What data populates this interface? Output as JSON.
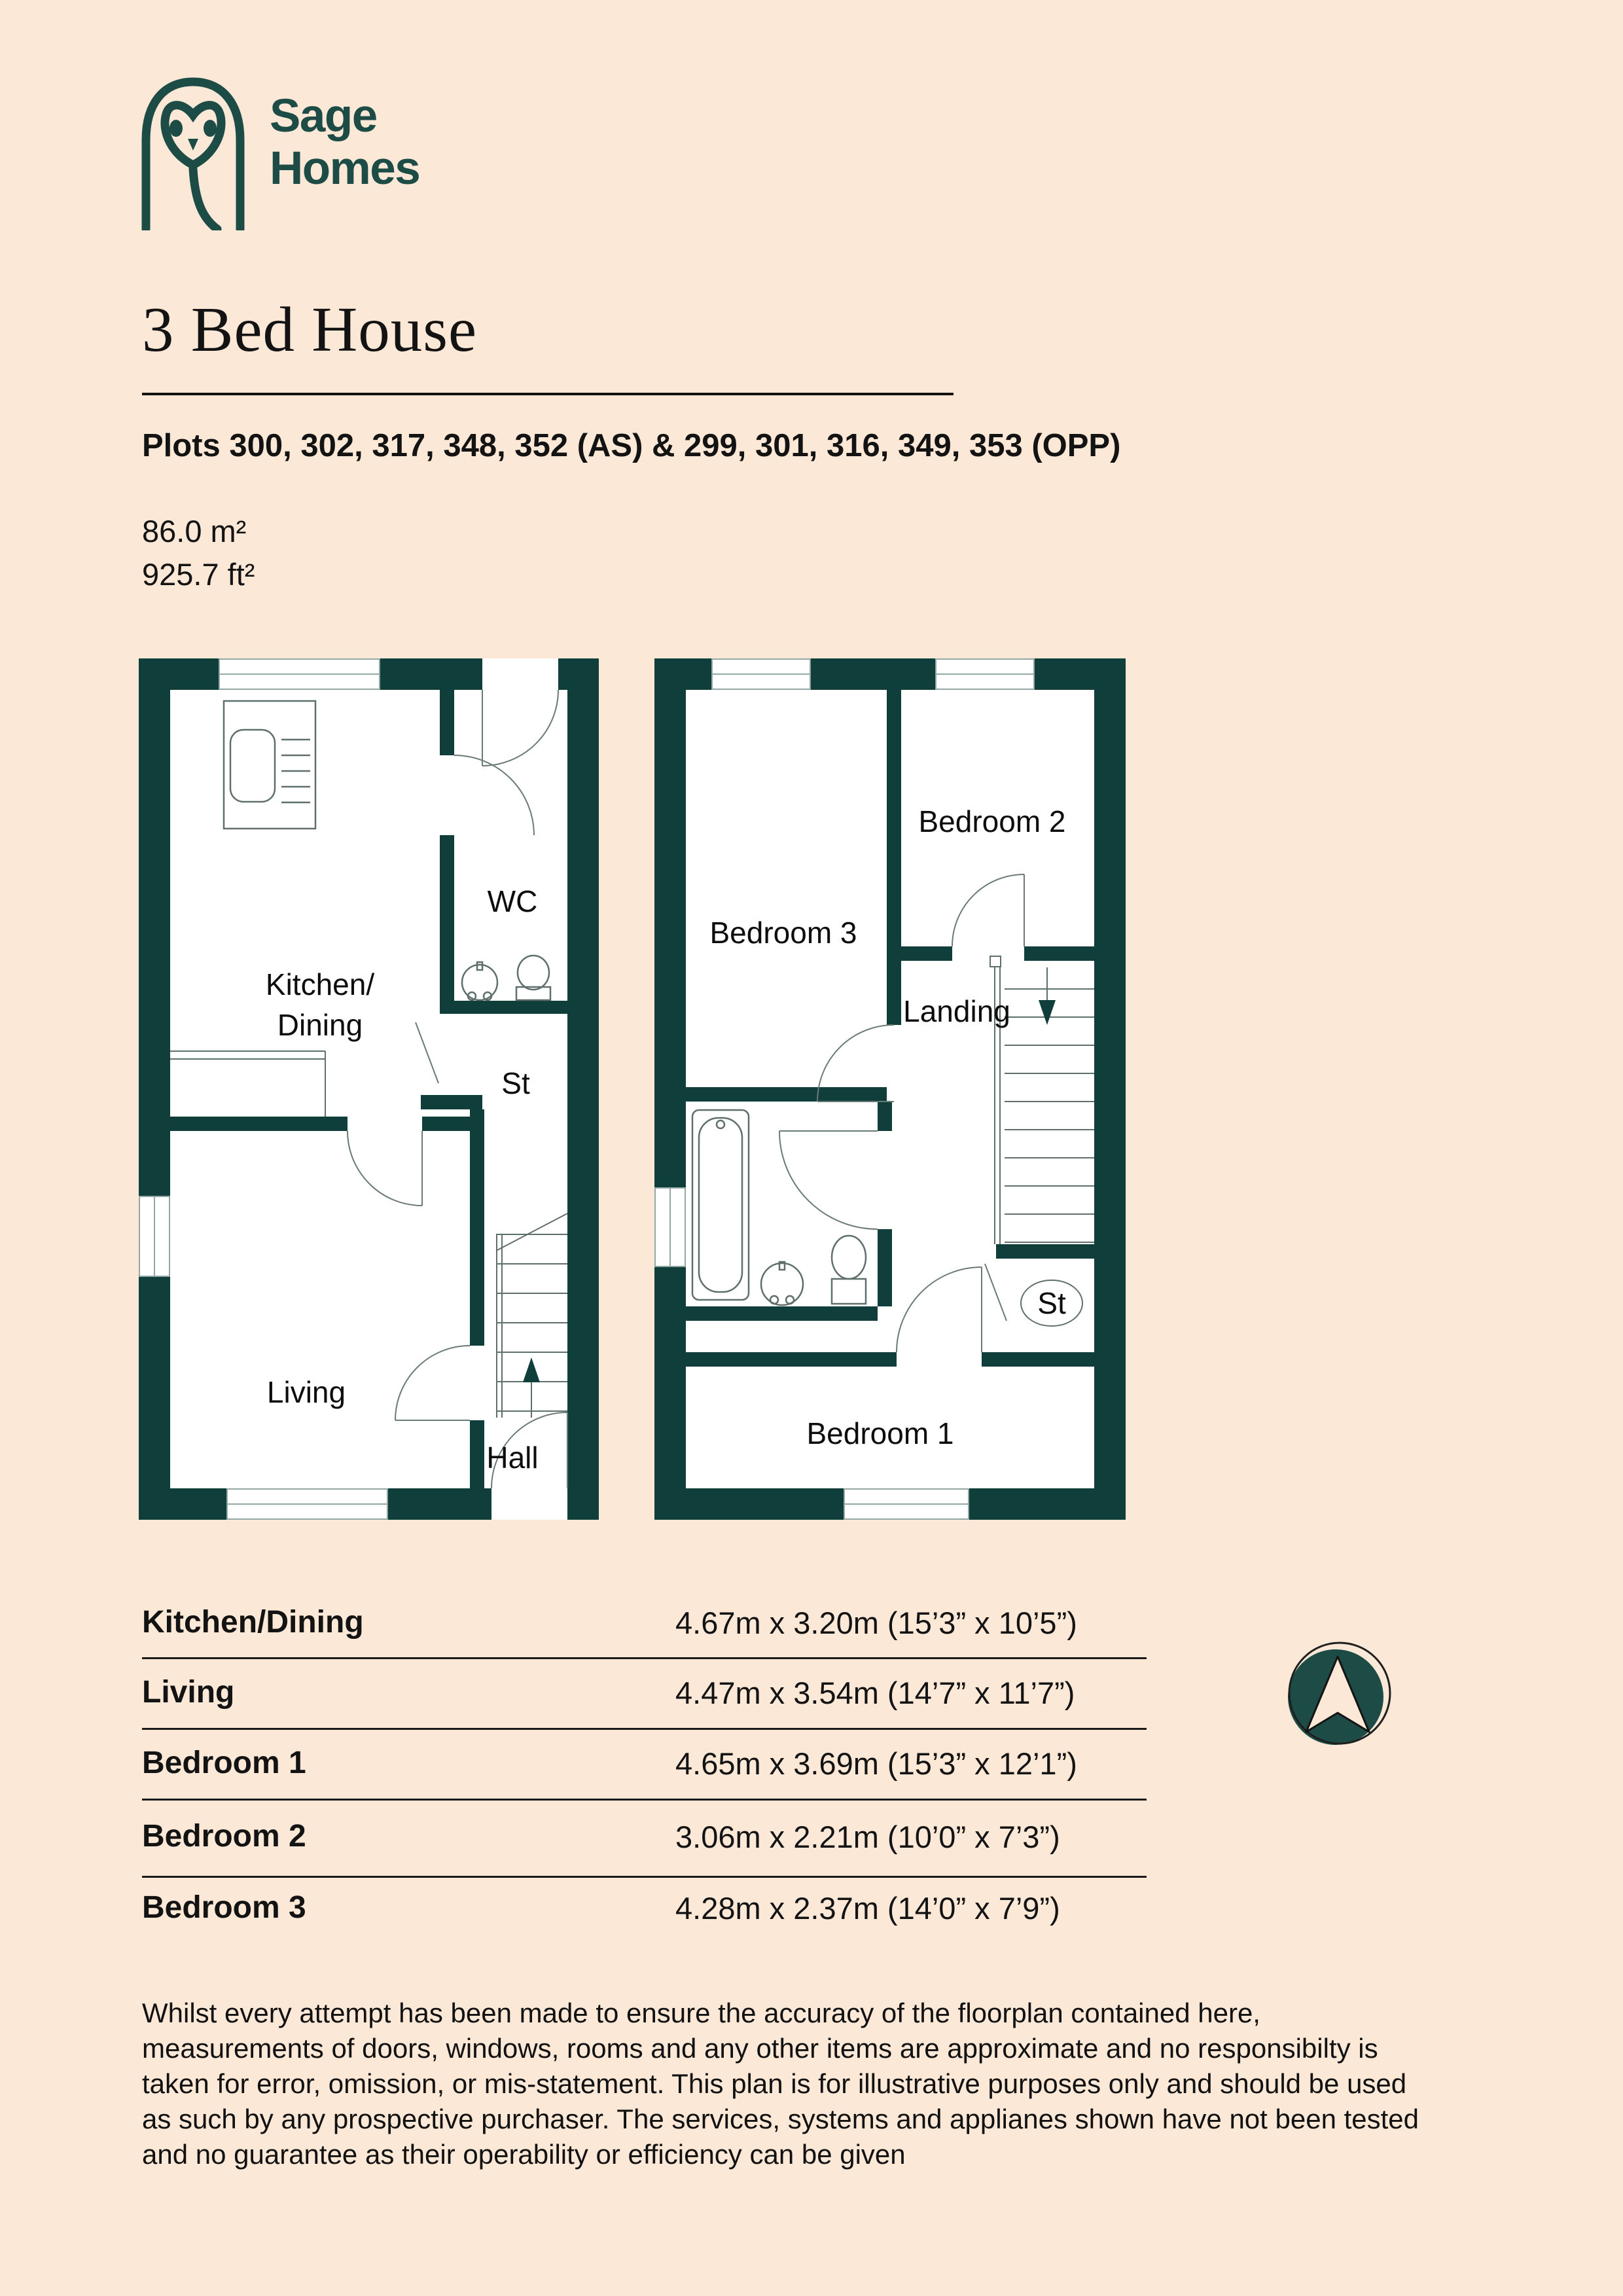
{
  "colors": {
    "background": "#fce8d7",
    "brand_teal": "#1d4b46",
    "wall_teal": "#0f3e3b",
    "text": "#131313"
  },
  "brand": {
    "logo_icon": "owl-logo-icon",
    "name_line1": "Sage",
    "name_line2": "Homes"
  },
  "header": {
    "title": "3 Bed House",
    "plots": "Plots 300, 302, 317, 348, 352 (AS) & 299, 301, 316, 349, 353 (OPP)",
    "areas": "86.0 m²\n925.7 ft²"
  },
  "ground_floor": {
    "rooms": {
      "kitchen_dining": "Kitchen/\nDining",
      "wc": "WC",
      "store": "St",
      "living": "Living",
      "hall": "Hall"
    }
  },
  "first_floor": {
    "rooms": {
      "bedroom3": "Bedroom 3",
      "bedroom2": "Bedroom 2",
      "landing": "Landing",
      "store": "St",
      "bedroom1": "Bedroom 1"
    }
  },
  "dimensions_table": {
    "rows": [
      {
        "room": "Kitchen/Dining",
        "size": "4.67m x 3.20m (15’3” x 10’5”)"
      },
      {
        "room": "Living",
        "size": "4.47m x 3.54m (14’7” x 11’7”)"
      },
      {
        "room": "Bedroom 1",
        "size": "4.65m x 3.69m (15’3” x 12’1”)"
      },
      {
        "room": "Bedroom 2",
        "size": "3.06m x 2.21m (10’0” x 7’3”)"
      },
      {
        "room": "Bedroom 3",
        "size": "4.28m x 2.37m (14’0” x 7’9”)"
      }
    ]
  },
  "compass": {
    "icon": "north-arrow-icon"
  },
  "disclaimer": "Whilst every attempt has been made to ensure the accuracy of the floorplan contained here,\nmeasurements of doors, windows, rooms and any other items are approximate and no responsibilty is\ntaken for error, omission, or mis-statement. This plan is for illustrative purposes only and should be used\nas such by any prospective purchaser. The services, systems and applianes shown have not been tested\nand no guarantee as their operability or efficiency can be given"
}
